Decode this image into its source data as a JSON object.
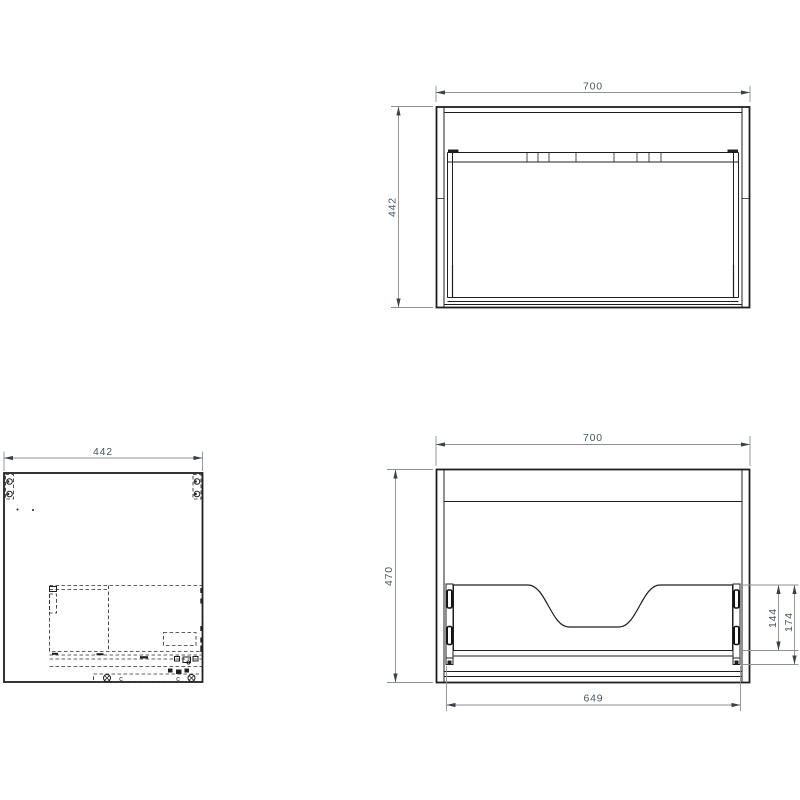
{
  "drawing": {
    "colors": {
      "part_line": "#1f1f1f",
      "dimension_line": "#8f8f8f",
      "dimension_text": "#4a5560",
      "background": "#ffffff"
    },
    "plan_view": {
      "width_mm": "700",
      "depth_mm": "442"
    },
    "side_panel_view": {
      "depth_mm": "442",
      "markers": {
        "left": "c",
        "right": "c"
      }
    },
    "front_view": {
      "width_mm": "700",
      "height_mm": "470",
      "inner_width_mm": "649",
      "rail_offset_mm": "144",
      "bracket_offset_mm": "174"
    }
  }
}
